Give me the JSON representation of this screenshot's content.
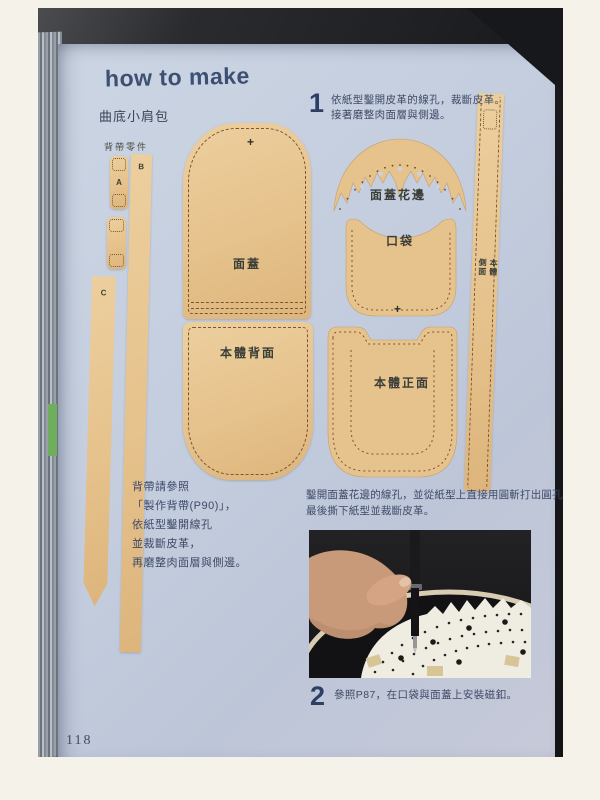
{
  "book_page": {
    "title": "how to make",
    "subtitle": "曲底小肩包",
    "page_number": "118"
  },
  "strap_parts": {
    "section_label": "背帶零件",
    "piece_a": "A",
    "piece_b": "B",
    "piece_c": "C"
  },
  "patterns": {
    "flap": {
      "label": "面蓋",
      "mark": "+"
    },
    "flap_lace": {
      "label": "面蓋花邊"
    },
    "pocket": {
      "label": "口袋",
      "mark": "+"
    },
    "body_side": {
      "label": "本體側面"
    },
    "body_back": {
      "label": "本體背面"
    },
    "body_front": {
      "label": "本體正面"
    }
  },
  "steps": [
    {
      "number": "1",
      "lines": [
        "依紙型鑿開皮革的線孔，裁斷皮革。",
        "接著磨整肉面層與側邊。"
      ]
    },
    {
      "number": "2",
      "lines": [
        "參照P87，在口袋與面蓋上安裝磁釦。"
      ]
    }
  ],
  "notes": {
    "strap_note": [
      "背帶請參照",
      "「製作背帶(P90)」，",
      "依紙型鑿開線孔",
      "並裁斷皮革，",
      "再磨整肉面層與側邊。"
    ],
    "lace_note": [
      "鑿開面蓋花邊的線孔，並從紙型上直接用圓斬打出圓孔，",
      "最後撕下紙型並裁斷皮革。"
    ]
  },
  "colors": {
    "leather_tan": "#e6c28c",
    "page_blue": "#c4cedd",
    "ink_navy": "#2e3f66",
    "stitch_brown": "#7a5530"
  }
}
